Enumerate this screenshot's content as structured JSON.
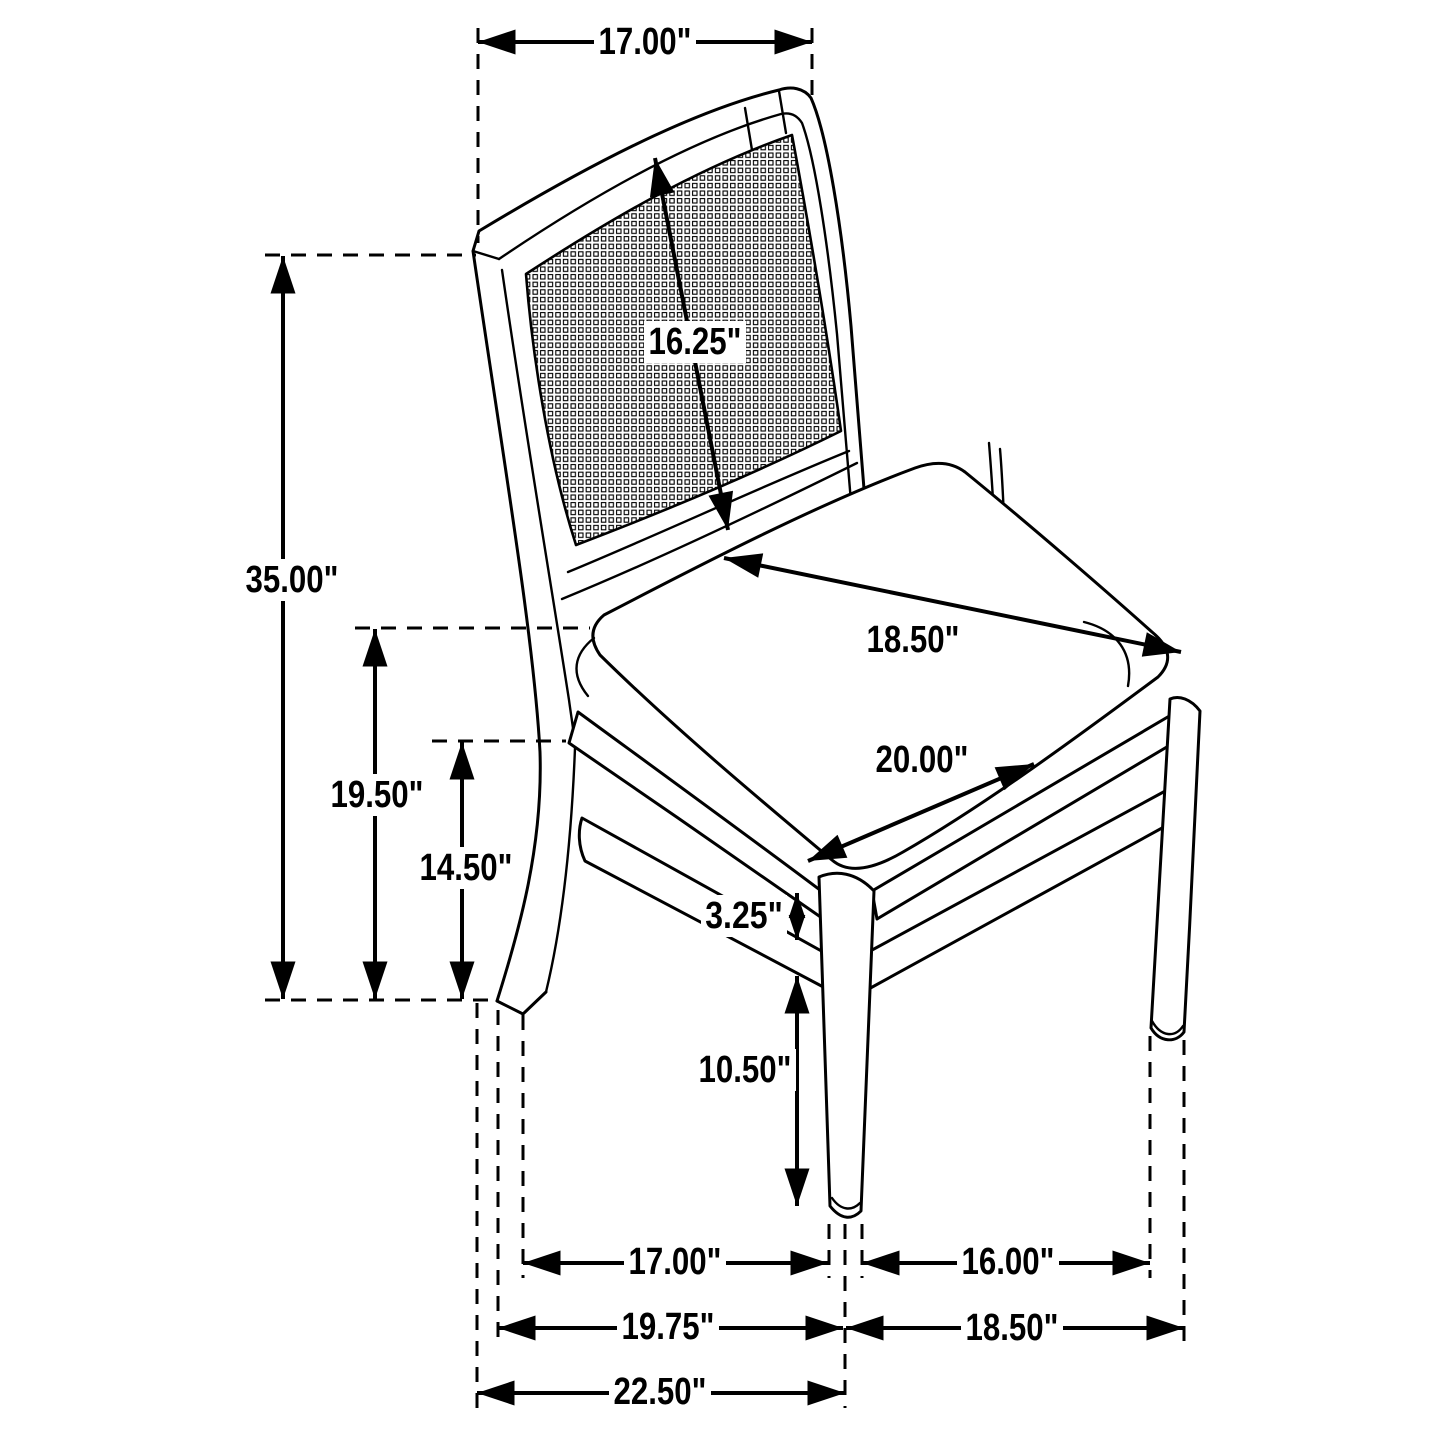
{
  "figure": {
    "kind": "furniture dimension diagram",
    "subject": "cane-back dining side chair line drawing",
    "background_color": "#ffffff",
    "line_color": "#000000",
    "unit_suffix": "\"",
    "dimensions": [
      {
        "id": "back_width_top",
        "value": 17.0,
        "label": "17.00\""
      },
      {
        "id": "overall_height",
        "value": 35.0,
        "label": "35.00\""
      },
      {
        "id": "seat_height",
        "value": 19.5,
        "label": "19.50\""
      },
      {
        "id": "apron_bottom_height",
        "value": 14.5,
        "label": "14.50\""
      },
      {
        "id": "back_panel_diagonal",
        "value": 16.25,
        "label": "16.25\""
      },
      {
        "id": "seat_depth",
        "value": 18.5,
        "label": "18.50\""
      },
      {
        "id": "seat_width",
        "value": 20.0,
        "label": "20.00\""
      },
      {
        "id": "apron_to_stretcher_gap",
        "value": 3.25,
        "label": "3.25\""
      },
      {
        "id": "stretcher_to_floor",
        "value": 10.5,
        "label": "10.50\""
      },
      {
        "id": "floor_span_side",
        "value": 17.0,
        "label": "17.00\""
      },
      {
        "id": "floor_span_front",
        "value": 16.0,
        "label": "16.00\""
      },
      {
        "id": "floor_depth_mid",
        "value": 19.75,
        "label": "19.75\""
      },
      {
        "id": "floor_width_overall",
        "value": 18.5,
        "label": "18.50\""
      },
      {
        "id": "floor_depth_overall",
        "value": 22.5,
        "label": "22.50\""
      }
    ]
  }
}
